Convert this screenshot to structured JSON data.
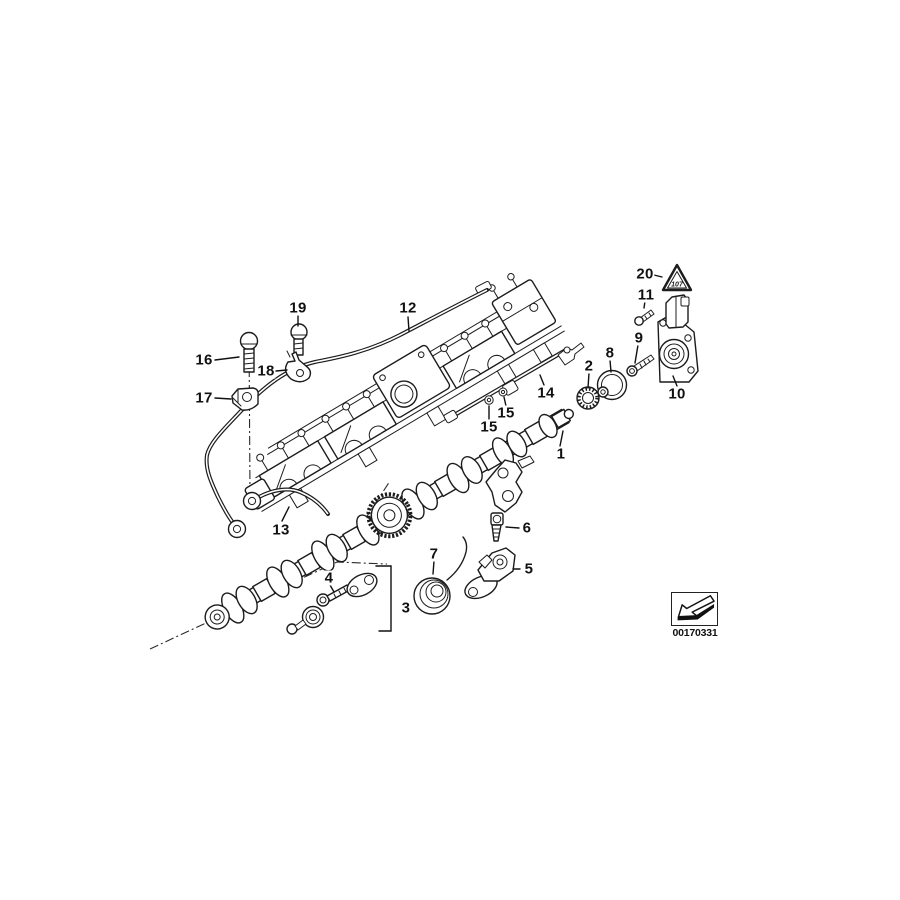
{
  "diagram": {
    "callouts": [
      {
        "label": "1",
        "x": 561,
        "y": 454,
        "leader": [
          560,
          446,
          563,
          431
        ]
      },
      {
        "label": "2",
        "x": 589,
        "y": 366,
        "leader": [
          589,
          373,
          588,
          388
        ]
      },
      {
        "label": "3",
        "x": 406,
        "y": 608,
        "leader": null
      },
      {
        "label": "4",
        "x": 329,
        "y": 578,
        "leader": [
          330,
          585,
          334,
          592
        ]
      },
      {
        "label": "5",
        "x": 529,
        "y": 569,
        "leader": [
          520,
          569,
          513,
          569
        ]
      },
      {
        "label": "6",
        "x": 527,
        "y": 528,
        "leader": [
          519,
          528,
          506,
          527
        ]
      },
      {
        "label": "7",
        "x": 434,
        "y": 554,
        "leader": [
          434,
          561,
          433,
          574
        ]
      },
      {
        "label": "8",
        "x": 610,
        "y": 353,
        "leader": [
          610,
          360,
          611,
          372
        ]
      },
      {
        "label": "9",
        "x": 639,
        "y": 338,
        "leader": [
          638,
          345,
          635,
          363
        ]
      },
      {
        "label": "10",
        "x": 677,
        "y": 394,
        "leader": [
          677,
          386,
          673,
          376
        ]
      },
      {
        "label": "11",
        "x": 646,
        "y": 295,
        "leader": [
          645,
          301,
          644,
          308
        ]
      },
      {
        "label": "12",
        "x": 408,
        "y": 308,
        "leader": [
          408,
          317,
          409,
          331
        ]
      },
      {
        "label": "13",
        "x": 281,
        "y": 530,
        "leader": [
          282,
          521,
          289,
          507
        ]
      },
      {
        "label": "14",
        "x": 546,
        "y": 393,
        "leader": [
          544,
          385,
          540,
          375
        ]
      },
      {
        "label": "15",
        "x": 489,
        "y": 427,
        "leader": [
          489,
          419,
          489,
          406
        ]
      },
      {
        "label": "15",
        "x": 506,
        "y": 413,
        "leader": [
          506,
          406,
          504,
          397
        ]
      },
      {
        "label": "16",
        "x": 204,
        "y": 360,
        "leader": [
          215,
          360,
          239,
          357
        ]
      },
      {
        "label": "17",
        "x": 204,
        "y": 398,
        "leader": [
          215,
          398,
          231,
          399
        ]
      },
      {
        "label": "18",
        "x": 266,
        "y": 371,
        "leader": [
          276,
          371,
          287,
          370
        ]
      },
      {
        "label": "19",
        "x": 298,
        "y": 308,
        "leader": [
          298,
          316,
          298,
          326
        ]
      },
      {
        "label": "20",
        "x": 645,
        "y": 274,
        "leader": [
          654,
          275,
          662,
          277
        ]
      }
    ],
    "warning_triangle": {
      "text": "107"
    },
    "stamp": {
      "image_number": "00170331"
    }
  }
}
